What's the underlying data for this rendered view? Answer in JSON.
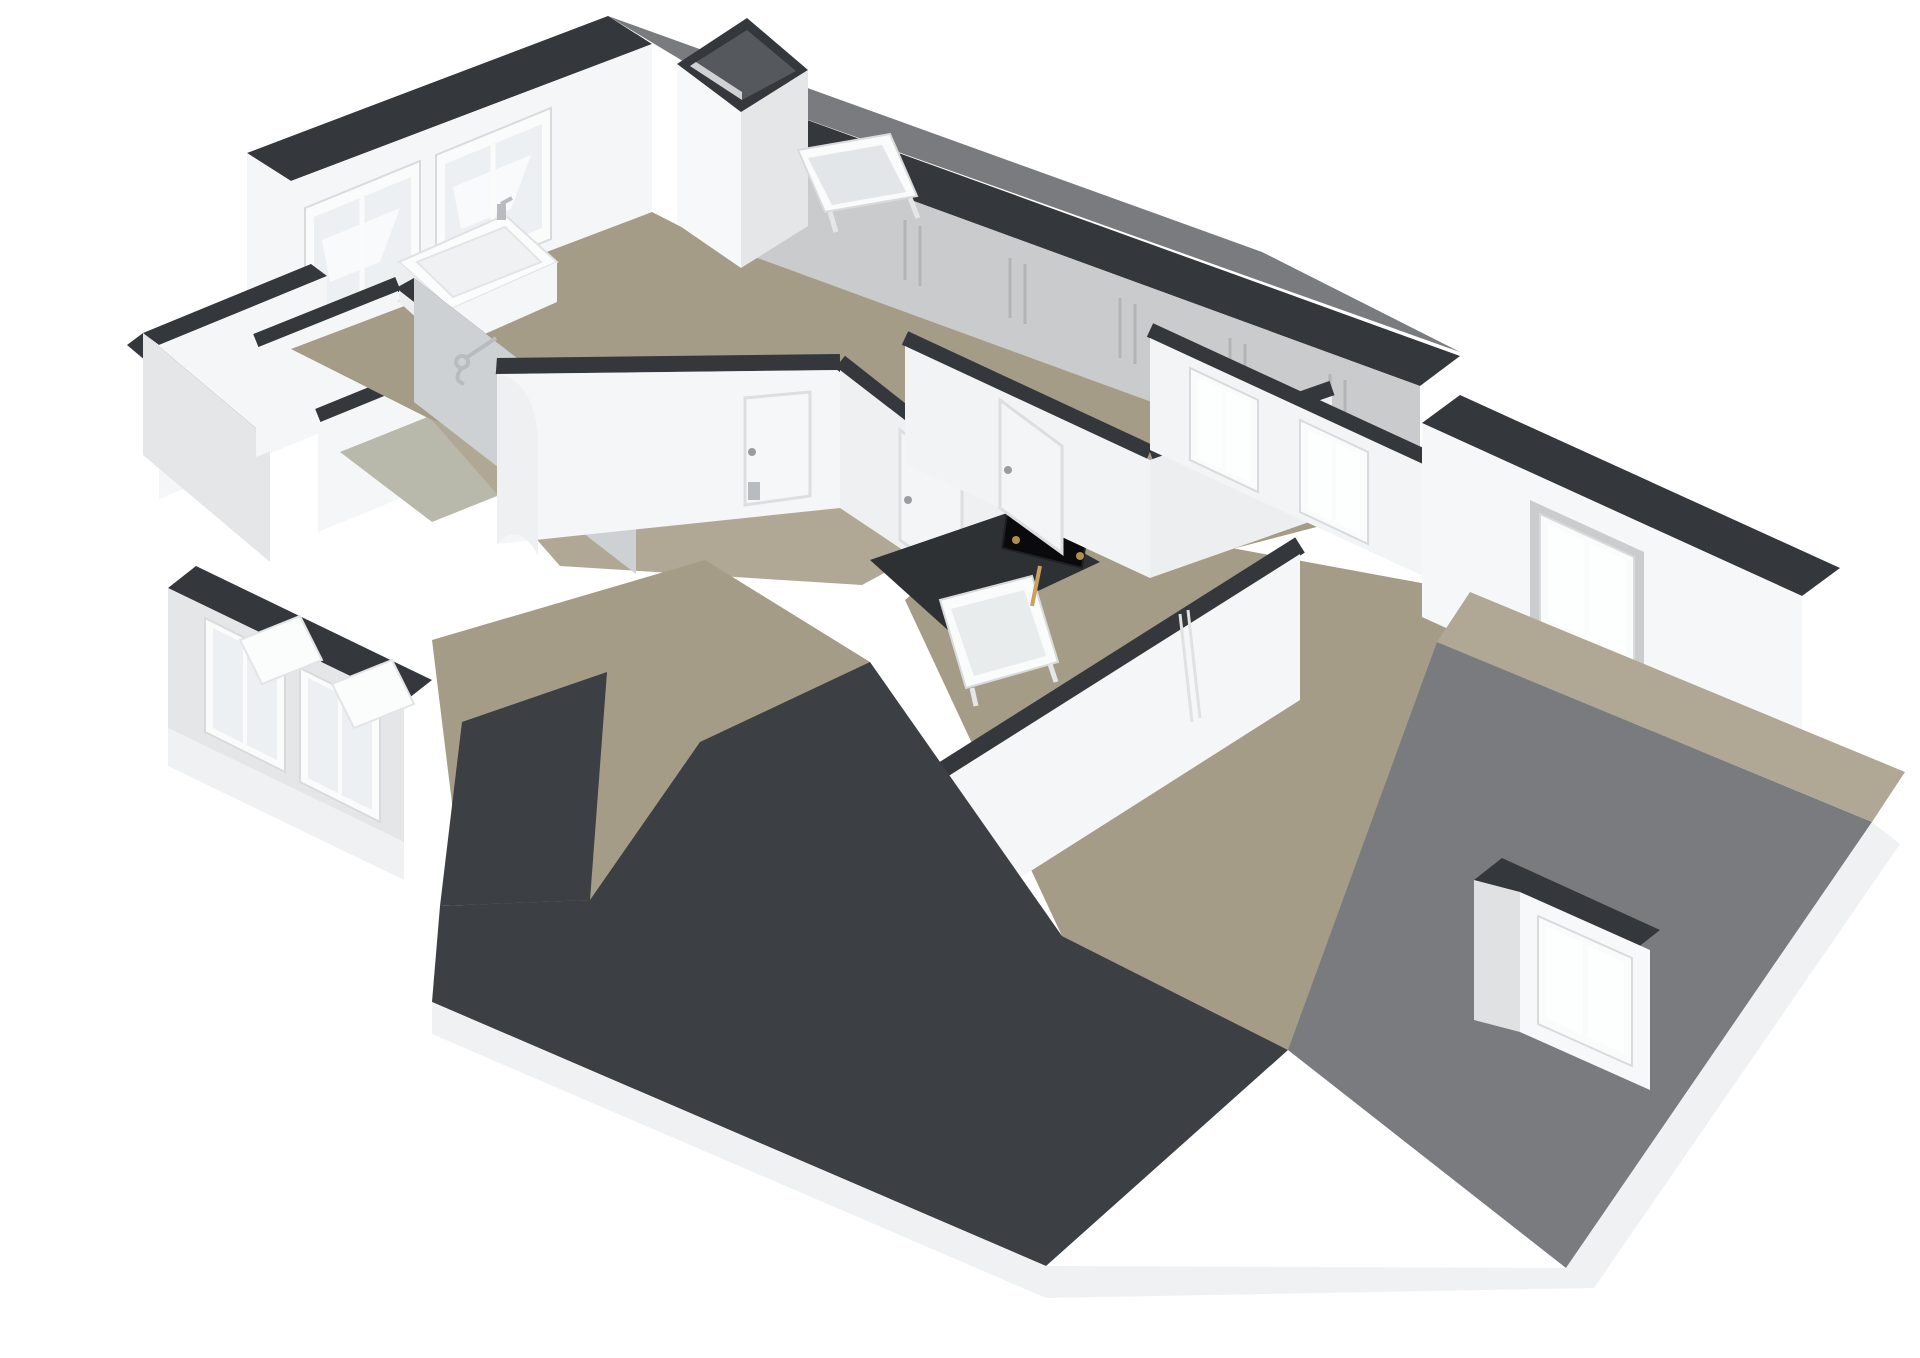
{
  "meta": {
    "title": "3D floor plan render - attic storey (dollhouse cutaway view)",
    "projection": "axonometric birds-eye, rotated 45 degrees",
    "background": "#ffffff",
    "contains_text": false
  },
  "colors": {
    "background": "#ffffff",
    "wall_cap": "#34373b",
    "wall_white": "#f5f6f7",
    "wall_shade": "#e4e6e8",
    "wall_gray": "#c9cbcd",
    "floor_taupe": "#a59c87",
    "floor_taupe_light": "#b0a894",
    "floor_sage": "#b9b9ab",
    "roof_dark": "#3c3f43",
    "roof_gray": "#797b7e",
    "glass": "#edf0f2",
    "glass_bright": "#fdfefe",
    "frame_white": "#fafbfb",
    "chrome": "#b9bcbe",
    "tv_black": "#0a0a0c",
    "tv_brass": "#b08d4a",
    "fascia": "#f0f1f2"
  },
  "scene": {
    "rooms": [
      {
        "name": "bathroom",
        "floor": "taupe",
        "fixtures": [
          "bathtub",
          "bath-faucet",
          "shower-set",
          "windows-nw"
        ]
      },
      {
        "name": "closet-wing",
        "floor": "taupe",
        "cells": 3,
        "note": "small service rooms at west corner, one with sage floor"
      },
      {
        "name": "landing",
        "floor": "taupe",
        "fixtures": [
          "chimney",
          "leaning-skylight",
          "radiator-knee-wall"
        ]
      },
      {
        "name": "hallway",
        "floor": "taupe-light",
        "fixtures": [
          "curved-wall",
          "doors-with-handles",
          "wall-switch"
        ]
      },
      {
        "name": "stairwell",
        "floor": "void",
        "fixtures": [
          "tilted-window-panel",
          "flat-tv-leaning"
        ]
      },
      {
        "name": "bedroom-northeast",
        "floor": "taupe",
        "fixtures": [
          "two-bright-windows"
        ]
      },
      {
        "name": "attic-living-room",
        "floor": "taupe",
        "fixtures": [
          "door-ajar",
          "recessed-corner-window",
          "roof-terrace-ledge",
          "dormer-window"
        ]
      },
      {
        "name": "bedroom-southwest",
        "floor": "taupe",
        "fixtures": [
          "two-windows-with-seats",
          "roof-valley-cutouts"
        ]
      }
    ],
    "roof_elements": [
      "northeast-roof-slope",
      "ridge-cap-bands",
      "front-dark-roof-valleys",
      "southeast-gray-roof-plane",
      "white-fascia-boards"
    ]
  }
}
